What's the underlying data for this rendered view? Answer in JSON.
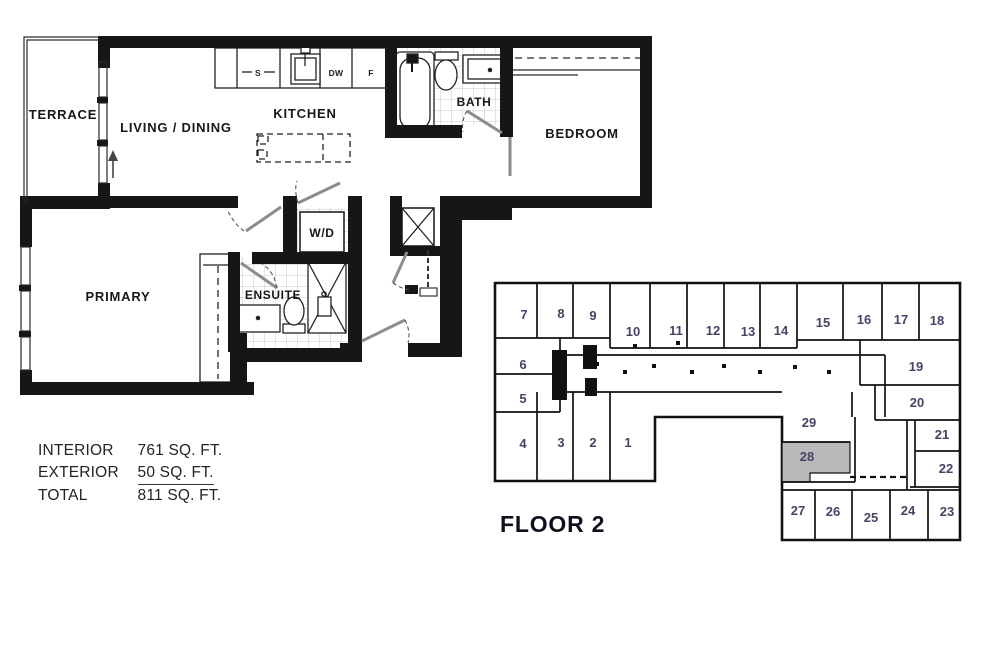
{
  "floorplan": {
    "rooms": {
      "terrace": "TERRACE",
      "living_dining": "LIVING / DINING",
      "kitchen": "KITCHEN",
      "bath": "BATH",
      "bedroom": "BEDROOM",
      "primary": "PRIMARY",
      "ensuite": "ENSUITE",
      "laundry": "W/D"
    },
    "appliances": {
      "sink": "S",
      "dishwasher": "DW",
      "fridge": "F"
    }
  },
  "area_summary": {
    "rows": [
      {
        "label": "INTERIOR",
        "value": "761 SQ. FT."
      },
      {
        "label": "EXTERIOR",
        "value": "50 SQ. FT."
      },
      {
        "label": "TOTAL",
        "value": "811 SQ. FT."
      }
    ]
  },
  "keyplan": {
    "floor_label": "FLOOR 2",
    "highlighted_unit": "28",
    "highlight_color": "#b9b9b9",
    "number_color": "#4a4266",
    "units": [
      {
        "n": "1",
        "x": 138,
        "y": 169
      },
      {
        "n": "2",
        "x": 103,
        "y": 169
      },
      {
        "n": "3",
        "x": 71,
        "y": 169
      },
      {
        "n": "4",
        "x": 33,
        "y": 170
      },
      {
        "n": "5",
        "x": 33,
        "y": 125
      },
      {
        "n": "6",
        "x": 33,
        "y": 91
      },
      {
        "n": "7",
        "x": 34,
        "y": 41
      },
      {
        "n": "8",
        "x": 71,
        "y": 40
      },
      {
        "n": "9",
        "x": 103,
        "y": 42
      },
      {
        "n": "10",
        "x": 143,
        "y": 58
      },
      {
        "n": "11",
        "x": 186,
        "y": 57
      },
      {
        "n": "12",
        "x": 223,
        "y": 57
      },
      {
        "n": "13",
        "x": 258,
        "y": 58
      },
      {
        "n": "14",
        "x": 291,
        "y": 57
      },
      {
        "n": "15",
        "x": 333,
        "y": 49
      },
      {
        "n": "16",
        "x": 374,
        "y": 46
      },
      {
        "n": "17",
        "x": 411,
        "y": 46
      },
      {
        "n": "18",
        "x": 447,
        "y": 47
      },
      {
        "n": "19",
        "x": 426,
        "y": 93
      },
      {
        "n": "20",
        "x": 427,
        "y": 129
      },
      {
        "n": "21",
        "x": 452,
        "y": 161
      },
      {
        "n": "22",
        "x": 456,
        "y": 195
      },
      {
        "n": "23",
        "x": 457,
        "y": 238
      },
      {
        "n": "24",
        "x": 418,
        "y": 237
      },
      {
        "n": "25",
        "x": 381,
        "y": 244
      },
      {
        "n": "26",
        "x": 343,
        "y": 238
      },
      {
        "n": "27",
        "x": 308,
        "y": 237
      },
      {
        "n": "28",
        "x": 317,
        "y": 183
      },
      {
        "n": "29",
        "x": 319,
        "y": 149
      }
    ]
  },
  "colors": {
    "wall": "#161616",
    "door_leaf": "#8c8c8c",
    "tile": "#c9c9c9"
  }
}
